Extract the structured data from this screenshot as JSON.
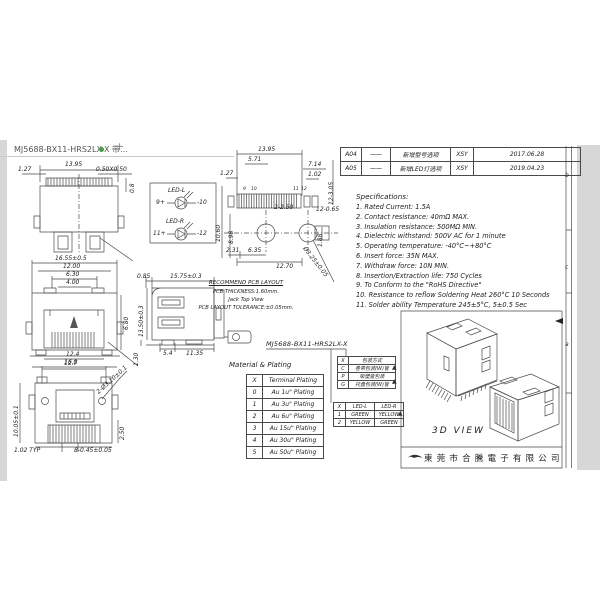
{
  "tab": {
    "title": "MJ5688-BX11-HRS2LX-X 带...",
    "plus": "+"
  },
  "revisions": {
    "rows": [
      {
        "rev": "A04",
        "mark": "——",
        "desc": "新增型号选项",
        "by": "XSY",
        "date": "2017.06.28"
      },
      {
        "rev": "A05",
        "mark": "——",
        "desc": "新增LED灯选项",
        "by": "XSY",
        "date": "2019.04.23"
      }
    ]
  },
  "specs": {
    "title": "Specifications:",
    "items": [
      "1. Rated Current: 1.5A",
      "2. Contact resistance: 40mΩ MAX.",
      "3. Insulation resistance: 500MΩ MIN.",
      "4. Dielectric withstand: 500V AC for 1 minute",
      "5. Operating temperature: -40°C~+80°C",
      "6. Insert force: 35N MAX.",
      "7. Withdraw force: 10N MIN.",
      "8. Insertion/Extraction life: 750 Cycles",
      "9. To Conform to the \"RoHS Directive\"",
      "10. Resistance to reflow Soldering Heat 260°C 10 Seconds",
      "11. Solder ability Temperature 245±5°C, 5±0.5 Sec"
    ]
  },
  "pcb_note": {
    "l1": "RECOMMEND PCB LAYOUT",
    "l2": "PCB THICKNESS:1.60mm.",
    "l3": "Jack Top View",
    "l4": "PCB LAYOUT TOLERANCE:±0.05mm."
  },
  "part_number": "MJ5688-BX11-HRS2LX-X",
  "material_table": {
    "title": "Material & Plating",
    "header": [
      "X",
      "Terminal Plating"
    ],
    "rows": [
      [
        "0",
        "Au 1u\" Plating"
      ],
      [
        "1",
        "Au 3u\" Plating"
      ],
      [
        "2",
        "Au 6u\" Plating"
      ],
      [
        "3",
        "Au 15u\" Plating"
      ],
      [
        "4",
        "Au 30u\" Plating"
      ],
      [
        "5",
        "Au 50u\" Plating"
      ]
    ]
  },
  "packing_table": {
    "rows": [
      [
        "X",
        "包装方式"
      ],
      [
        "C",
        "卷带包装(W)管"
      ],
      [
        "P",
        "吸塑盒包装"
      ],
      [
        "G",
        "托盘包装(W)管"
      ]
    ]
  },
  "led_table": {
    "header": [
      "X",
      "LED-L",
      "LED-R"
    ],
    "rows": [
      [
        "1",
        "GREEN",
        "YELLOW"
      ],
      [
        "2",
        "YELLOW",
        "GREEN"
      ]
    ]
  },
  "led_legend": {
    "left_label": "LED-L",
    "left_pos": "9+",
    "left_neg": "-10",
    "right_label": "LED-R",
    "right_pos": "11+",
    "right_neg": "-12"
  },
  "threed_label": "3D VIEW",
  "company": "東莞市合騰電子有限公司",
  "zones": {
    "b": "b",
    "c": "c",
    "a": "a"
  },
  "marker": "▲",
  "dims": {
    "v1": [
      "1.27",
      "13.95",
      "0.50X0.50",
      "0.8"
    ],
    "v2": [
      "16.55±0.5",
      "12.00",
      "6.30",
      "4.00",
      "6.80",
      "12.4",
      "16.8"
    ],
    "v3": [
      "12.7",
      "2-Ø3.10±0.1",
      "10.05±0.1",
      "2.50",
      "1.02 TYP",
      "8-0.45±0.05"
    ],
    "v4": [
      "0.85",
      "15.75±0.3",
      "13.50±0.3",
      "1.30",
      "5.4",
      "11.35"
    ],
    "v5": [
      "13.95",
      "5.71",
      "1.27",
      "7.14",
      "1.02",
      "12-3.05",
      "12-0.65",
      "2-2.50",
      "10.60",
      "8.98",
      "2.31",
      "6.35",
      "12.70",
      "Ø3.25±0.05",
      "1.88",
      "9",
      "10",
      "11",
      "12"
    ]
  }
}
